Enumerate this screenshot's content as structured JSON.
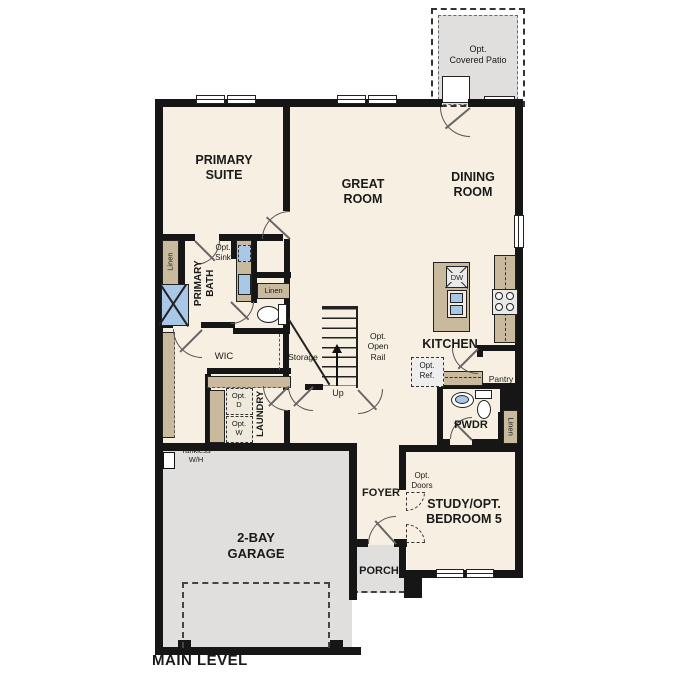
{
  "colors": {
    "wall": "#161616",
    "floor": "#f7f0e2",
    "gray": "#e0dfdd",
    "cab": "#c9ba9e",
    "blue": "#a9c8e7"
  },
  "rooms": {
    "patio": "Opt.\nCovered Patio",
    "primary_suite": "PRIMARY\nSUITE",
    "great_room": "GREAT\nROOM",
    "dining_room": "DINING\nROOM",
    "primary_bath": "PRIMARY\nBATH",
    "wic": "WIC",
    "storage": "Storage",
    "laundry": "LAUNDRY",
    "kitchen": "KITCHEN",
    "pantry": "Pantry",
    "pwdr": "PWDR",
    "foyer": "FOYER",
    "study": "STUDY/OPT.\nBEDROOM 5",
    "garage": "2-BAY\nGARAGE",
    "porch": "PORCH"
  },
  "labels": {
    "linen": "Linen",
    "opt_sink": "Opt.\nSink",
    "opt_open_rail": "Opt.\nOpen\nRail",
    "up": "Up",
    "opt_ref": "Opt.\nRef.",
    "opt_d": "Opt.\nD",
    "opt_w": "Opt.\nW",
    "opt_doors": "Opt.\nDoors",
    "tankless_wh": "Tankless\nW/H",
    "dw": "DW",
    "main_level": "MAIN LEVEL"
  }
}
